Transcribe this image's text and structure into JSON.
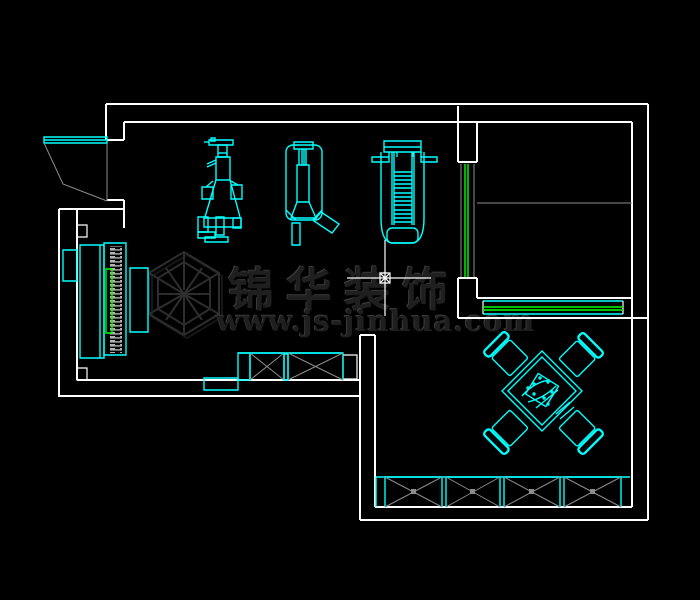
{
  "app": {
    "kind": "cad-floorplan-screenshot",
    "content": "residential interior floor plan with gym equipment, piano, bedroom, dining set and wardrobes"
  },
  "palette": {
    "background": "#000000",
    "wall": "#ffffff",
    "furniture": "#00ffff",
    "window_glass": "#00ff00",
    "hatch": "#8c8c8c",
    "watermark": "#1f1f1f"
  },
  "watermark": {
    "logo": "hexagon-cube-logo",
    "brand_text": "锦华装饰",
    "url_text": "www.js-jinhua.com"
  },
  "cursor": {
    "kind": "crosshair-with-square-snap-marker",
    "x": 385,
    "y": 278
  }
}
